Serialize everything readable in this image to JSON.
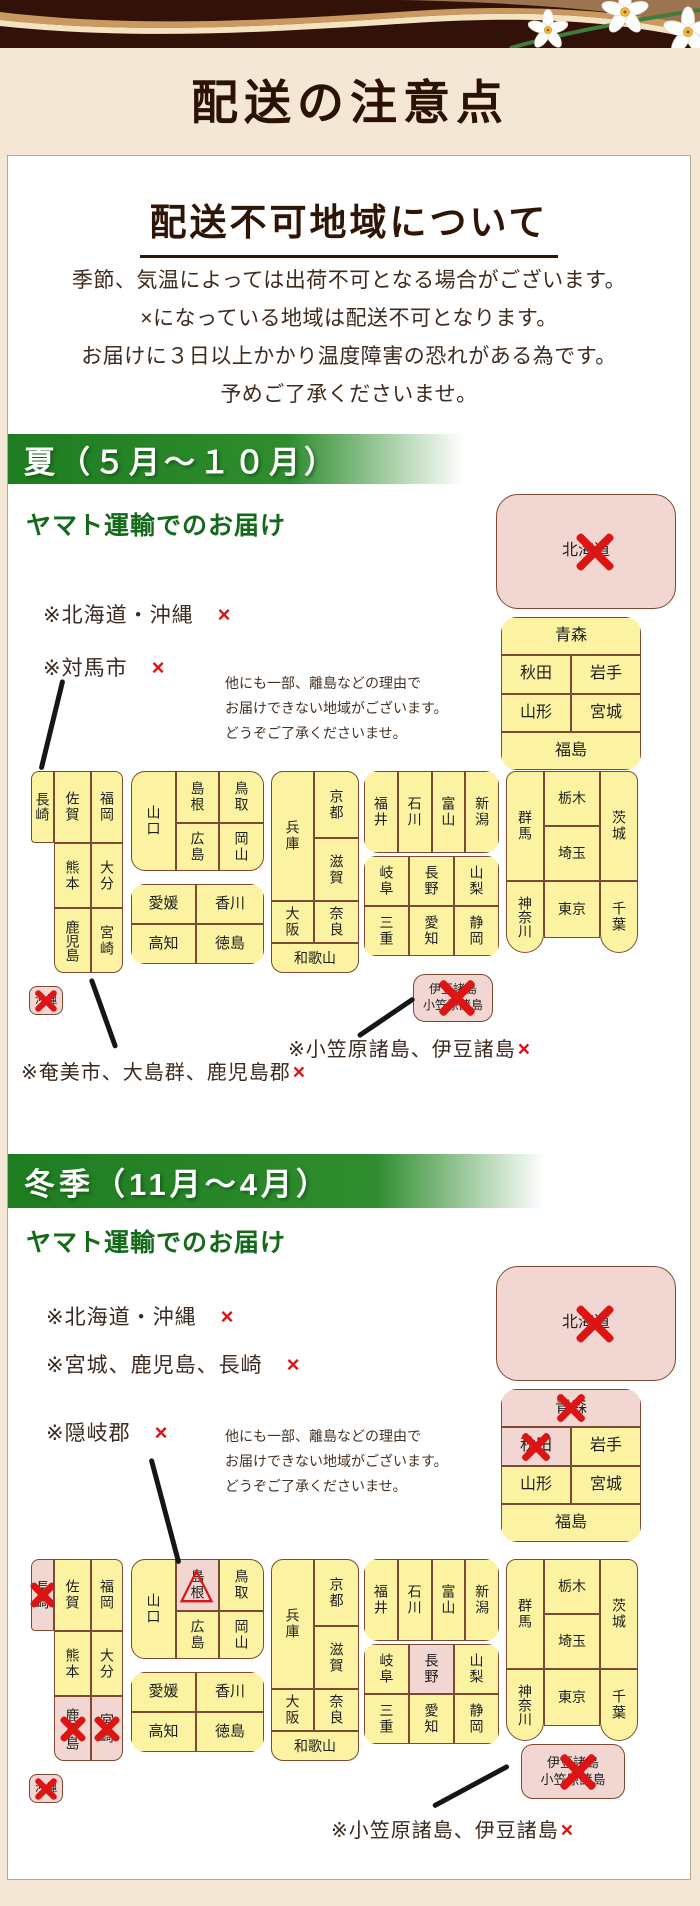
{
  "header": {
    "title": "配送の注意点"
  },
  "panel": {
    "heading": "配送不可地域について",
    "intro_lines": [
      "季節、気温によっては出荷不可となる場合がございます。",
      "×になっている地域は配送不可となります。",
      "お届けに３日以上かかり温度障害の恐れがある為です。",
      "予めご了承くださいませ。"
    ],
    "note_lines": [
      "他にも一部、離島などの理由で",
      "お届けできない地域がございます。",
      "どうぞご了承くださいませ。"
    ]
  },
  "summer": {
    "bar_label": "夏（５月～１０月）",
    "carrier_heading": "ヤマト運輸でのお届け",
    "exclusions": [
      {
        "text": "※北海道・沖縄",
        "mark": "×"
      },
      {
        "text": "※対馬市",
        "mark": "×"
      }
    ],
    "footnote_left": {
      "text": "※奄美市、大島群、鹿児島郡",
      "mark": "×"
    },
    "footnote_right": {
      "text": "※小笠原諸島、伊豆諸島",
      "mark": "×"
    }
  },
  "winter": {
    "bar_label": "冬季（11月～4月）",
    "carrier_heading": "ヤマト運輸でのお届け",
    "exclusions": [
      {
        "text": "※北海道・沖縄",
        "mark": "×"
      },
      {
        "text": "※宮城、鹿児島、長崎",
        "mark": "×"
      },
      {
        "text": "※隠岐郡",
        "mark": "×"
      }
    ],
    "footnote_right": {
      "text": "※小笠原諸島、伊豆諸島",
      "mark": "×"
    }
  },
  "maps": {
    "summer": {
      "hokkaido": {
        "label": "北海道",
        "status": "ng"
      },
      "tohoku": {
        "cells": [
          {
            "label": "青森",
            "status": "ok"
          },
          {
            "label": "秋田",
            "status": "ok"
          },
          {
            "label": "岩手",
            "status": "ok"
          },
          {
            "label": "山形",
            "status": "ok"
          },
          {
            "label": "宮城",
            "status": "ok"
          },
          {
            "label": "福島",
            "status": "ok"
          }
        ]
      },
      "kanto": {
        "cells": [
          {
            "label": "群馬",
            "status": "ok"
          },
          {
            "label": "栃木",
            "status": "ok"
          },
          {
            "label": "埼玉",
            "status": "ok"
          },
          {
            "label": "茨城",
            "status": "ok"
          },
          {
            "label": "神奈川",
            "status": "ok"
          },
          {
            "label": "東京",
            "status": "ok"
          },
          {
            "label": "千葉",
            "status": "ok"
          }
        ]
      },
      "chubu_n": {
        "cells": [
          {
            "label": "福井",
            "status": "ok"
          },
          {
            "label": "石川",
            "status": "ok"
          },
          {
            "label": "富山",
            "status": "ok"
          },
          {
            "label": "新潟",
            "status": "ok"
          }
        ]
      },
      "chubu_s": {
        "cells": [
          {
            "label": "岐阜",
            "status": "ok"
          },
          {
            "label": "長野",
            "status": "ok"
          },
          {
            "label": "山梨",
            "status": "ok"
          },
          {
            "label": "三重",
            "status": "ok"
          },
          {
            "label": "愛知",
            "status": "ok"
          },
          {
            "label": "静岡",
            "status": "ok"
          }
        ]
      },
      "kansai": {
        "cells": [
          {
            "label": "兵庫",
            "status": "ok"
          },
          {
            "label": "京都",
            "status": "ok"
          },
          {
            "label": "滋賀",
            "status": "ok"
          },
          {
            "label": "大阪",
            "status": "ok"
          },
          {
            "label": "奈良",
            "status": "ok"
          },
          {
            "label": "和歌山",
            "status": "ok"
          }
        ]
      },
      "chugoku": {
        "cells": [
          {
            "label": "山口",
            "status": "ok"
          },
          {
            "label": "島根",
            "status": "ok"
          },
          {
            "label": "広島",
            "status": "ok"
          },
          {
            "label": "鳥取",
            "status": "ok"
          },
          {
            "label": "岡山",
            "status": "ok"
          }
        ]
      },
      "shikoku": {
        "cells": [
          {
            "label": "愛媛",
            "status": "ok"
          },
          {
            "label": "香川",
            "status": "ok"
          },
          {
            "label": "高知",
            "status": "ok"
          },
          {
            "label": "徳島",
            "status": "ok"
          }
        ]
      },
      "kyushu": {
        "cells": [
          {
            "label": "長崎",
            "status": "ok"
          },
          {
            "label": "佐賀",
            "status": "ok"
          },
          {
            "label": "福岡",
            "status": "ok"
          },
          {
            "label": "熊本",
            "status": "ok"
          },
          {
            "label": "大分",
            "status": "ok"
          },
          {
            "label": "鹿児島",
            "status": "ok"
          },
          {
            "label": "宮崎",
            "status": "ok"
          }
        ]
      },
      "okinawa": {
        "label": "沖縄",
        "status": "ng"
      },
      "izu": {
        "line1": "伊豆諸島",
        "line2": "小笠原諸島",
        "status": "ng"
      }
    },
    "winter": {
      "hokkaido": {
        "label": "北海道",
        "status": "ng"
      },
      "tohoku": {
        "cells": [
          {
            "label": "青森",
            "status": "ng"
          },
          {
            "label": "秋田",
            "status": "ng"
          },
          {
            "label": "岩手",
            "status": "ok"
          },
          {
            "label": "山形",
            "status": "ok"
          },
          {
            "label": "宮城",
            "status": "ok"
          },
          {
            "label": "福島",
            "status": "ok"
          }
        ]
      },
      "kanto": {
        "cells": [
          {
            "label": "群馬",
            "status": "ok"
          },
          {
            "label": "栃木",
            "status": "ok"
          },
          {
            "label": "埼玉",
            "status": "ok"
          },
          {
            "label": "茨城",
            "status": "ok"
          },
          {
            "label": "神奈川",
            "status": "ok"
          },
          {
            "label": "東京",
            "status": "ok"
          },
          {
            "label": "千葉",
            "status": "ok"
          }
        ]
      },
      "chubu_n": {
        "cells": [
          {
            "label": "福井",
            "status": "ok"
          },
          {
            "label": "石川",
            "status": "ok"
          },
          {
            "label": "富山",
            "status": "ok"
          },
          {
            "label": "新潟",
            "status": "ok"
          }
        ]
      },
      "chubu_s": {
        "cells": [
          {
            "label": "岐阜",
            "status": "ok"
          },
          {
            "label": "長野",
            "status": "hl"
          },
          {
            "label": "山梨",
            "status": "ok"
          },
          {
            "label": "三重",
            "status": "ok"
          },
          {
            "label": "愛知",
            "status": "ok"
          },
          {
            "label": "静岡",
            "status": "ok"
          }
        ]
      },
      "kansai": {
        "cells": [
          {
            "label": "兵庫",
            "status": "ok"
          },
          {
            "label": "京都",
            "status": "ok"
          },
          {
            "label": "滋賀",
            "status": "ok"
          },
          {
            "label": "大阪",
            "status": "ok"
          },
          {
            "label": "奈良",
            "status": "ok"
          },
          {
            "label": "和歌山",
            "status": "ok"
          }
        ]
      },
      "chugoku": {
        "cells": [
          {
            "label": "山口",
            "status": "ok"
          },
          {
            "label": "島根",
            "status": "warn"
          },
          {
            "label": "広島",
            "status": "ok"
          },
          {
            "label": "鳥取",
            "status": "ok"
          },
          {
            "label": "岡山",
            "status": "ok"
          }
        ]
      },
      "shikoku": {
        "cells": [
          {
            "label": "愛媛",
            "status": "ok"
          },
          {
            "label": "香川",
            "status": "ok"
          },
          {
            "label": "高知",
            "status": "ok"
          },
          {
            "label": "徳島",
            "status": "ok"
          }
        ]
      },
      "kyushu": {
        "cells": [
          {
            "label": "長崎",
            "status": "ng"
          },
          {
            "label": "佐賀",
            "status": "ok"
          },
          {
            "label": "福岡",
            "status": "ok"
          },
          {
            "label": "熊本",
            "status": "ok"
          },
          {
            "label": "大分",
            "status": "ok"
          },
          {
            "label": "鹿児島",
            "status": "ng"
          },
          {
            "label": "宮崎",
            "status": "ng"
          }
        ]
      },
      "okinawa": {
        "label": "沖縄",
        "status": "ng"
      },
      "izu": {
        "line1": "伊豆諸島",
        "line2": "小笠原諸島",
        "status": "ng"
      }
    }
  }
}
